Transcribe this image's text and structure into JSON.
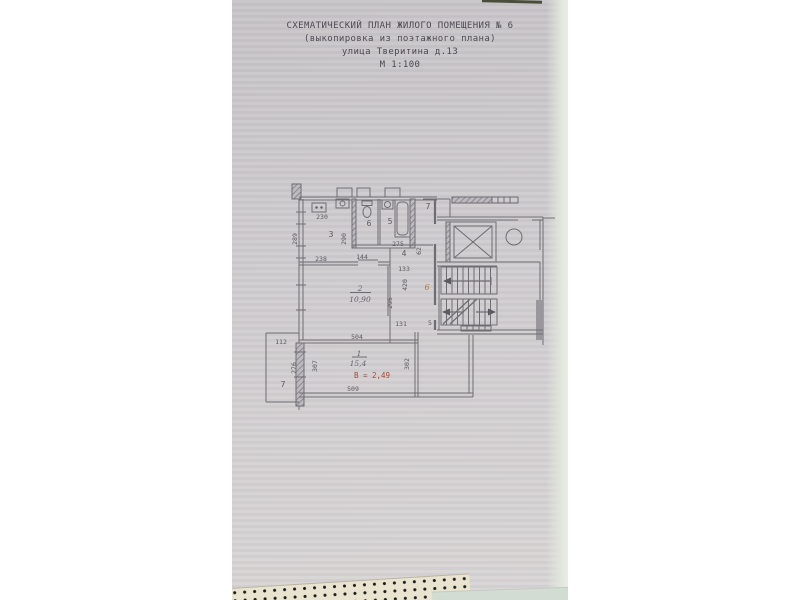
{
  "document": {
    "header": {
      "line1": "СХЕМАТИЧЕСКИЙ ПЛАН ЖИЛОГО ПОМЕЩЕНИЯ № 6",
      "line2": "(выкопировка из поэтажного плана)",
      "line3": "улица Тверитина д.13",
      "line4": "М 1:100"
    }
  },
  "plan": {
    "labels": {
      "kitchen_width": "230",
      "kitchen_number": "3",
      "kitchen_bottom": "238",
      "kitchen_left": "289",
      "kitchen_right": "290",
      "wc_number": "6",
      "bath_number": "5",
      "bath_length": "275",
      "hall_width": "144",
      "hall_number": "4",
      "hall_side": "62",
      "hall_lower": "133",
      "hall_height": "420",
      "corridor_number": "7",
      "floor_mark": "6",
      "room2_depth": "295",
      "room2_number": "2",
      "room2_area": "10,90",
      "door_width": "131",
      "door_mark": "5",
      "room2_bottom": "504",
      "balcony_width": "112",
      "balcony_depth": "276",
      "balcony_number": "7",
      "room1_left": "307",
      "room1_number": "1",
      "room1_area": "15,4",
      "room1_height": "В = 2,49",
      "room1_bottom": "509",
      "room1_right": "302"
    }
  },
  "colors": {
    "paper": "#cecbce",
    "pencil_line": "#6f6d72",
    "red_note": "#a84b33",
    "orange_mark": "#b8742e"
  }
}
